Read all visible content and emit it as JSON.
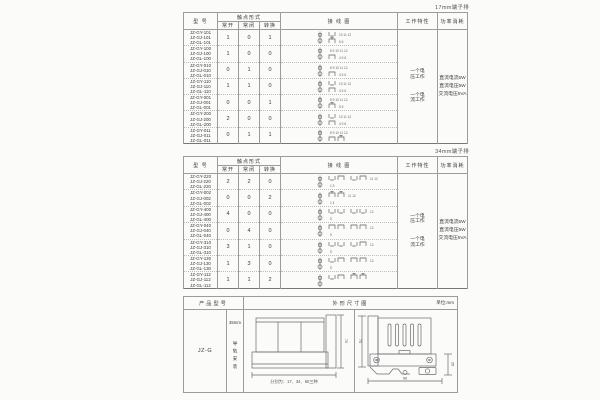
{
  "spec_tables": [
    {
      "terminal_label": "17mm端子排",
      "headers": {
        "model": "型 号",
        "contact_form": "触点形式",
        "no": "常开",
        "nc": "常闭",
        "co": "转换",
        "wiring": "接 线 图",
        "work": "工作特性",
        "power": "功率消耗"
      },
      "work_modes": [
        "一个电压工作",
        "一个电流工作"
      ],
      "power_items": [
        "直流电流5W",
        "直流电压5W",
        "交流电压5VA"
      ],
      "rows": [
        {
          "models": [
            "JZ-GY-101",
            "JZ-GJ-101",
            "JZ-GL-101"
          ],
          "no": "1",
          "nc": "0",
          "co": "1",
          "diagram": {
            "top": {
              "glyphs": [
                "u"
              ],
              "nums": "10 11 12"
            },
            "bottom": {
              "glyphs": [
                "t"
              ],
              "nums": "5 6"
            }
          }
        },
        {
          "models": [
            "JZ-GY-100",
            "JZ-GJ-100",
            "JZ-GL-100"
          ],
          "no": "1",
          "nc": "0",
          "co": "0",
          "diagram": {
            "top": {
              "glyphs": [],
              "nums": "8 9 10 11 12"
            },
            "bottom": {
              "glyphs": [
                "n"
              ],
              "nums": "4 5 6"
            }
          }
        },
        {
          "models": [
            "JZ-GY-010",
            "JZ-GJ-010",
            "JZ-GL-010"
          ],
          "no": "0",
          "nc": "1",
          "co": "0",
          "diagram": {
            "top": {
              "glyphs": [],
              "nums": "8 9 10 11 12"
            },
            "bottom": {
              "glyphs": [
                "n"
              ],
              "nums": "4 5 6"
            }
          }
        },
        {
          "models": [
            "JZ-GY-110",
            "JZ-GJ-110",
            "JZ-GL-110"
          ],
          "no": "1",
          "nc": "1",
          "co": "0",
          "diagram": {
            "top": {
              "glyphs": [
                "u"
              ],
              "nums": "10 11 12"
            },
            "bottom": {
              "glyphs": [
                "n"
              ],
              "nums": "4 5 6"
            }
          }
        },
        {
          "models": [
            "JZ-GY-001",
            "JZ-GJ-001",
            "JZ-GL-001"
          ],
          "no": "0",
          "nc": "0",
          "co": "1",
          "diagram": {
            "top": {
              "glyphs": [],
              "nums": "8 9 10 11 12"
            },
            "bottom": {
              "glyphs": [
                "t"
              ],
              "nums": "5 6"
            }
          }
        },
        {
          "models": [
            "JZ-GY-200",
            "JZ-GJ-200",
            "JZ-GL-200"
          ],
          "no": "2",
          "nc": "0",
          "co": "0",
          "diagram": {
            "top": {
              "glyphs": [
                "u"
              ],
              "nums": "10 11 12"
            },
            "bottom": {
              "glyphs": [
                "n"
              ],
              "nums": "4 5 6"
            }
          }
        },
        {
          "models": [
            "JZ-GY-011",
            "JZ-GJ-011",
            "JZ-GL-011"
          ],
          "no": "0",
          "nc": "1",
          "co": "1",
          "diagram": {
            "top": {
              "glyphs": [],
              "nums": "8 9 10 11 12"
            },
            "bottom": {
              "glyphs": [
                "n",
                "t"
              ],
              "nums": ""
            }
          }
        }
      ]
    },
    {
      "terminal_label": "34mm端子排",
      "headers": {
        "model": "型 号",
        "contact_form": "触点形式",
        "no": "常开",
        "nc": "常闭",
        "co": "转换",
        "wiring": "接 线 图",
        "work": "工作特性",
        "power": "功率消耗"
      },
      "work_modes": [
        "一个电压工作",
        "一个电流工作"
      ],
      "power_items": [
        "直流电流5W",
        "直流电压5W",
        "交流电压5VA"
      ],
      "rows": [
        {
          "models": [
            "JZ-GY-220",
            "JZ-GJ-220",
            "JZ-GL-220"
          ],
          "no": "2",
          "nc": "2",
          "co": "0",
          "diagram": {
            "top": {
              "glyphs": [
                "u",
                "n",
                "u",
                "n"
              ],
              "nums": "11 12"
            },
            "bottom": {
              "glyphs": [],
              "nums": "1 5"
            }
          }
        },
        {
          "models": [
            "JZ-GY-002",
            "JZ-GJ-002",
            "JZ-GL-002"
          ],
          "no": "0",
          "nc": "0",
          "co": "2",
          "diagram": {
            "top": {
              "glyphs": [
                "t",
                "t"
              ],
              "nums": "11 12"
            },
            "bottom": {
              "glyphs": [],
              "nums": "1 4"
            }
          }
        },
        {
          "models": [
            "JZ-GY-400",
            "JZ-GJ-400",
            "JZ-GL-400"
          ],
          "no": "4",
          "nc": "0",
          "co": "0",
          "diagram": {
            "top": {
              "glyphs": [
                "u",
                "u",
                "u",
                "u"
              ],
              "nums": "12"
            },
            "bottom": {
              "glyphs": [],
              "nums": "5"
            }
          }
        },
        {
          "models": [
            "JZ-GY-040",
            "JZ-GJ-040",
            "JZ-GL-040"
          ],
          "no": "0",
          "nc": "4",
          "co": "0",
          "diagram": {
            "top": {
              "glyphs": [
                "n",
                "n",
                "n",
                "n"
              ],
              "nums": "12"
            },
            "bottom": {
              "glyphs": [],
              "nums": "5"
            }
          }
        },
        {
          "models": [
            "JZ-GY-310",
            "JZ-GJ-310",
            "JZ-GL-310"
          ],
          "no": "3",
          "nc": "1",
          "co": "0",
          "diagram": {
            "top": {
              "glyphs": [
                "u",
                "u",
                "u",
                "n"
              ],
              "nums": "12"
            },
            "bottom": {
              "glyphs": [],
              "nums": "5"
            }
          }
        },
        {
          "models": [
            "JZ-GY-130",
            "JZ-GJ-130",
            "JZ-GL-130"
          ],
          "no": "1",
          "nc": "3",
          "co": "0",
          "diagram": {
            "top": {
              "glyphs": [
                "u",
                "n",
                "n",
                "n"
              ],
              "nums": "12"
            },
            "bottom": {
              "glyphs": [],
              "nums": "5"
            }
          }
        },
        {
          "models": [
            "JZ-GY-112",
            "JZ-GJ-112",
            "JZ-GL-112"
          ],
          "no": "1",
          "nc": "1",
          "co": "2",
          "diagram": {
            "top": {
              "glyphs": [
                "u",
                "n",
                "t",
                "t"
              ],
              "nums": ""
            },
            "bottom": {
              "glyphs": [],
              "nums": ""
            }
          }
        }
      ]
    }
  ],
  "outline_table": {
    "headers": {
      "product": "产品型号",
      "outline": "外形尺寸图",
      "unit": "单位:mm"
    },
    "model": "JZ-G",
    "mount_width": "35mm",
    "mount_text": "导轨安装",
    "front_view": {
      "height_label": "70",
      "note": "分别为：17、34、60三种"
    },
    "side_view": {
      "height_label": "70",
      "width_label": "90",
      "rail_label": "35"
    }
  }
}
